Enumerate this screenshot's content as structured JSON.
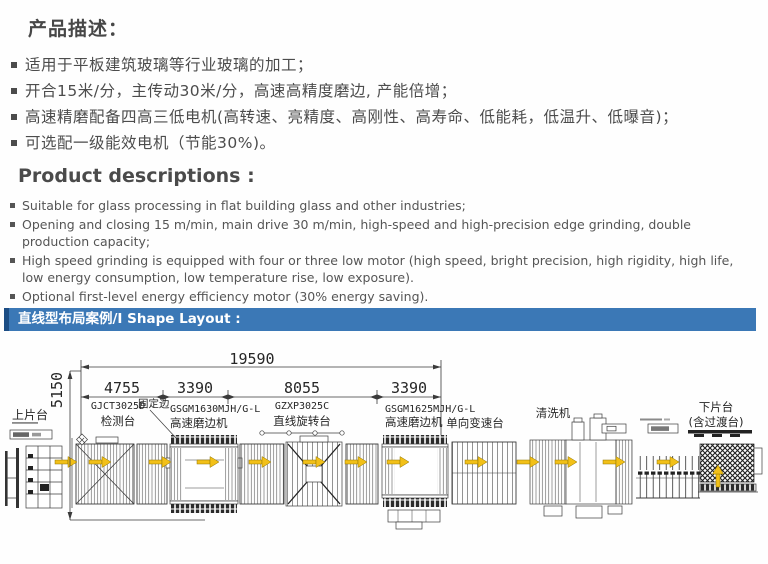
{
  "product_cn": {
    "heading": "产品描述：",
    "bullets": [
      "适用于平板建筑玻璃等行业玻璃的加工；",
      "开合15米/分，主传动30米/分，高速高精度磨边, 产能倍增；",
      "高速精磨配备四高三低电机(高转速、亮精度、高刚性、高寿命、低能耗，低温升、低曝音)；",
      "可选配一级能效电机（节能30%)。"
    ]
  },
  "product_en": {
    "heading": "Product descriptions :",
    "bullets": [
      "Suitable for glass processing in flat building glass and other industries;",
      "Opening and closing 15 m/min, main drive 30 m/min, high-speed and high-precision edge grinding, double production capacity;",
      "High speed grinding is equipped with four or three low motor (high speed, bright precision, high rigidity, high life, low energy consumption, low temperature rise, low exposure).",
      "Optional first-level energy efficiency motor (30% energy saving)."
    ]
  },
  "banner": {
    "label": "直线型布局案例/I Shape Layout :",
    "bg_color": "#3b78b6",
    "accent_color": "#1c4d84"
  },
  "diagram": {
    "dim_total": "19590",
    "dim_height": "5150",
    "dim_segments": [
      "4755",
      "3390",
      "8055",
      "3390"
    ],
    "stations": {
      "loading": "上片台",
      "fixed_edge": "固定边",
      "detect_model": "GJCT3025D",
      "detect_name": "检测台",
      "grinder1_model": "GSGM1630MJH/G-L",
      "grinder1_name": "高速磨边机",
      "rotary_model": "GZXP3025C",
      "rotary_name": "直线旋转台",
      "grinder2_model": "GSGM1625MJH/G-L",
      "grinder2_name": "高速磨边机",
      "speed_table": "单向变速台",
      "washer": "清洗机",
      "unloading_line1": "下片台",
      "unloading_line2": "(含过渡台)"
    },
    "arrow_color": "#f2c018",
    "line_color": "#3c3c3c"
  }
}
